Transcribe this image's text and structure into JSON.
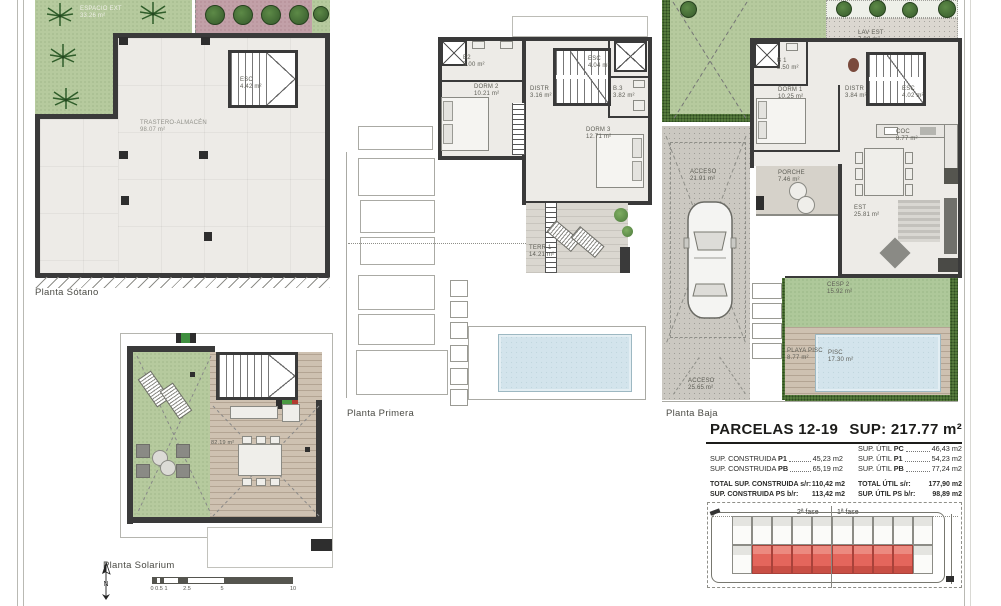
{
  "sheet": {
    "plan_titles": {
      "sotano": "Planta Sótano",
      "primera": "Planta Primera",
      "baja": "Planta Baja",
      "solarium": "Planta Solarium"
    }
  },
  "plans": {
    "sotano": {
      "rooms": {
        "espacio_ext": {
          "name": "ESPACIO EXT",
          "area": "33.26 m²"
        },
        "trastero": {
          "name": "TRASTERO-ALMACÉN",
          "area": "98.07 m²"
        },
        "esc": {
          "name": "ESC",
          "area": "4.42 m²"
        }
      }
    },
    "primera": {
      "rooms": {
        "b2": {
          "name": "B2",
          "area": "5.00 m²"
        },
        "dorm2": {
          "name": "DORM 2",
          "area": "10.21 m²"
        },
        "distr": {
          "name": "DISTR",
          "area": "3.16 m²"
        },
        "esc": {
          "name": "ESC",
          "area": "4.04 m²"
        },
        "b3": {
          "name": "B.3",
          "area": "3.82 m²"
        },
        "dorm3": {
          "name": "DORM 3",
          "area": "12.71 m²"
        },
        "terr1": {
          "name": "TERR 1",
          "area": "14.21 m²"
        }
      }
    },
    "baja": {
      "rooms": {
        "lav_est": {
          "name": "LAV EST",
          "area": "7.89 m²"
        },
        "b1": {
          "name": "B 1",
          "area": "3.50 m²"
        },
        "dorm1": {
          "name": "DORM 1",
          "area": "10.25 m²"
        },
        "distr": {
          "name": "DISTR",
          "area": "3.84 m²"
        },
        "esc": {
          "name": "ESC",
          "area": "4.02 m²"
        },
        "coc": {
          "name": "COC",
          "area": "8.77 m²"
        },
        "porche": {
          "name": "PORCHE",
          "area": "7.46 m²"
        },
        "acceso1": {
          "name": "ACCESO",
          "area": "21.91 m²"
        },
        "est": {
          "name": "EST",
          "area": "25.81 m²"
        },
        "cesp2": {
          "name": "CESP 2",
          "area": "15.92 m²"
        },
        "playa_pisc": {
          "name": "PLAYA PISC",
          "area": "8.77 m²"
        },
        "pisc": {
          "name": "PISC",
          "area": "17.30 m²"
        },
        "acceso2": {
          "name": "ACCESO",
          "area": "25.65 m²"
        }
      }
    },
    "solarium": {
      "rooms": {
        "terraza": {
          "name": "",
          "area": "82.19 m²"
        }
      }
    }
  },
  "summary": {
    "title": "PARCELAS 12-19",
    "total_sup": "SUP: 217.77 m²",
    "construida_rows": [
      {
        "prefix": "SUP. CONSTRUIDA ",
        "key": "P1",
        "value": "45,23 m2"
      },
      {
        "prefix": "SUP. CONSTRUIDA ",
        "key": "PB",
        "value": "65,19 m2"
      }
    ],
    "util_rows": [
      {
        "prefix": "SUP. ÚTIL ",
        "key": "PC",
        "value": "46,43 m2"
      },
      {
        "prefix": "SUP. ÚTIL ",
        "key": "P1",
        "value": "54,23 m2"
      },
      {
        "prefix": "SUP. ÚTIL ",
        "key": "PB",
        "value": "77,24 m2"
      }
    ],
    "construida_totals": [
      {
        "label": "TOTAL SUP. CONSTRUIDA s/r:",
        "value": "110,42 m2"
      },
      {
        "label": "SUP. CONSTRUIDA PS b/r:",
        "value": "113,42 m2"
      }
    ],
    "util_totals": [
      {
        "label": "TOTAL ÚTIL s/r:",
        "value": "177,90 m2"
      },
      {
        "label": "SUP. ÚTIL PS b/r:",
        "value": "98,89 m2"
      }
    ],
    "site_plan": {
      "fase2_label": "2ª fase",
      "fase1_label": "1ª fase",
      "highlight_color": "#e4665c"
    }
  },
  "scalebar": {
    "north_label": "N",
    "ticks": [
      "0",
      "0.5",
      "1",
      "2.5",
      "5",
      "10"
    ]
  }
}
